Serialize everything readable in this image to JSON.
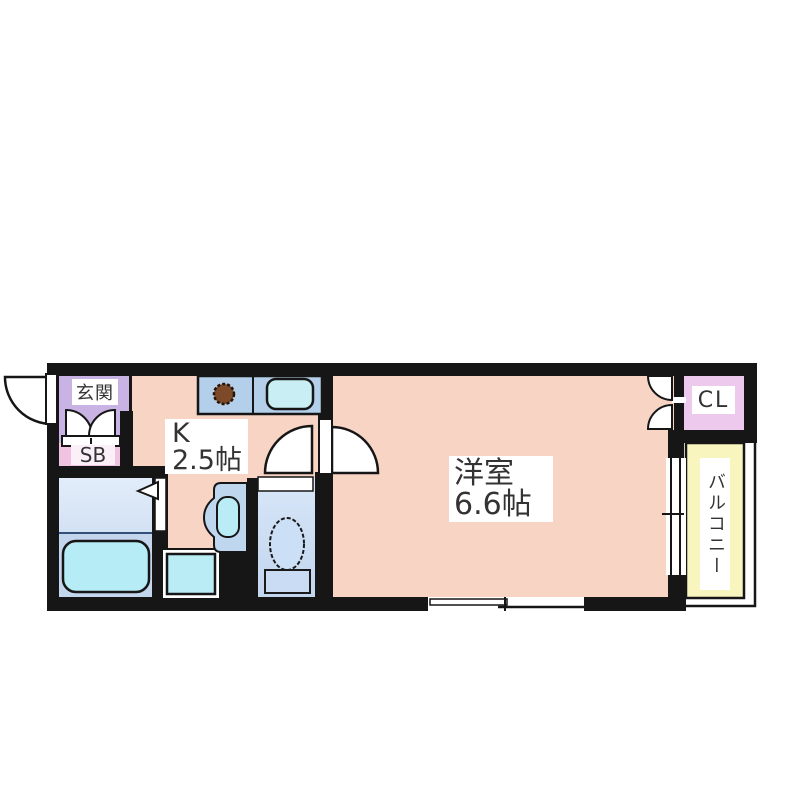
{
  "plan": {
    "rooms": {
      "entrance": {
        "label": "玄関"
      },
      "shoe_box": {
        "label": "SB"
      },
      "kitchen": {
        "abbr": "K",
        "size": "2.5帖"
      },
      "main_room": {
        "name": "洋室",
        "size": "6.6帖"
      },
      "closet": {
        "label": "CL"
      },
      "balcony": {
        "label": "バルコニー"
      }
    },
    "colors": {
      "wall": "#161616",
      "floor_pink": "#f8d4c5",
      "entrance_lavender": "#c9b2e4",
      "shoe_box_pink": "#f0c3e0",
      "closet_pink": "#eec9ee",
      "balcony_yellow": "#f9f5bf",
      "counter_blue": "#b4cfe9",
      "fixture_cyan": "#b9ecf5",
      "bath_floor_light": "#dce8f7",
      "bath_floor_dark": "#c3d6ee",
      "toilet_room_blue": "#cfe0f4",
      "basin_unit_blue": "#bfd6ef",
      "stove_brown": "#7c4a28"
    },
    "fixtures": [
      "entrance-door",
      "shoe-cabinet-doors",
      "kitchen-counter",
      "stove-burner",
      "kitchen-sink",
      "bathtub",
      "bathroom-folding-door",
      "washing-machine-pan",
      "washbasin",
      "toilet",
      "toilet-door",
      "room-door",
      "closet-double-doors",
      "balcony-sliding-door",
      "sliding-window"
    ]
  }
}
